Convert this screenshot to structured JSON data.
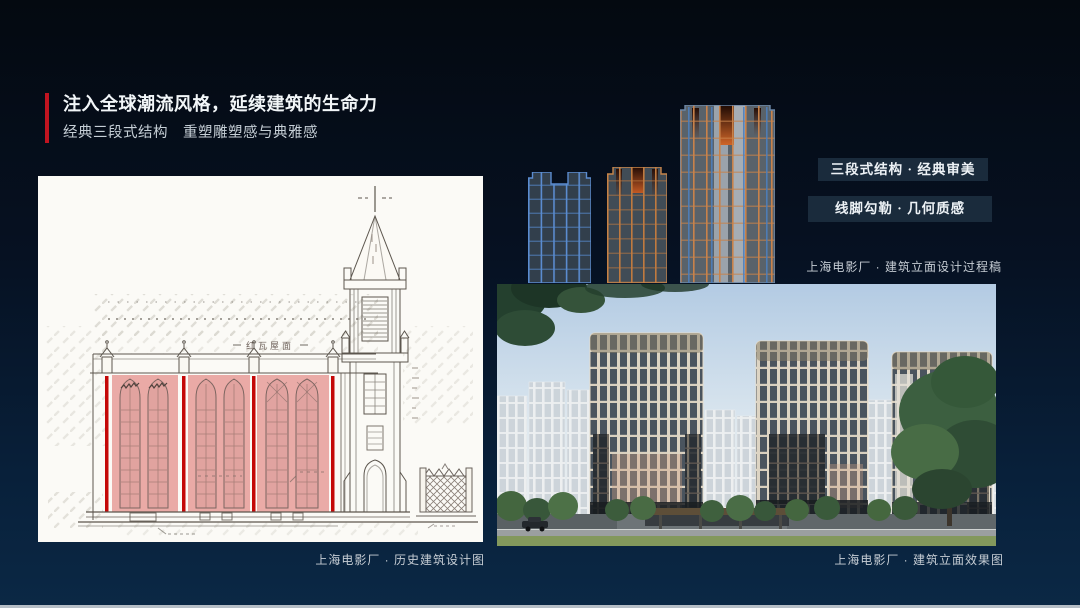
{
  "slide": {
    "background_top": "#040910",
    "background_bottom": "#0b2845",
    "bottom_bar_color": "#b6bec6"
  },
  "header": {
    "accent_color": "#c11420",
    "title": "注入全球潮流风格，延续建筑的生命力",
    "subtitle": "经典三段式结构　重塑雕塑感与典雅感"
  },
  "historic_figure": {
    "caption": "上海电影厂 · 历史建筑设计图",
    "annotation": "红瓦屋面",
    "highlight_color": "#e69793",
    "accent_bar_color": "#c40808"
  },
  "process_figure": {
    "badges": [
      "三段式结构 · 经典审美",
      "线脚勾勒 · 几何质感"
    ],
    "caption": "上海电影厂 · 建筑立面设计过程稿",
    "building_outline_blue": "#5b8cd0",
    "building_outline_bronze": "#c8854a"
  },
  "render_figure": {
    "caption": "上海电影厂 · 建筑立面效果图"
  }
}
